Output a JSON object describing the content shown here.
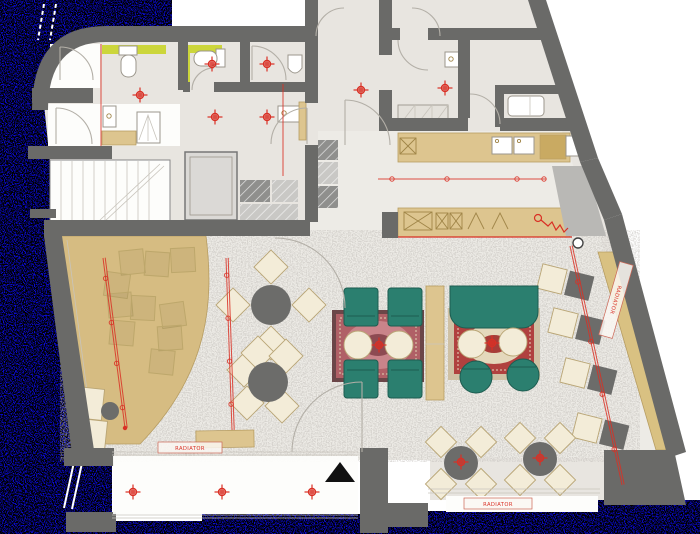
{
  "document": {
    "kind": "Scanned architectural floor plan",
    "subject": "Cafe lounge ground floor with bathrooms, kitchen bar, seating platform and terrace"
  },
  "labels": {
    "radiator_left": "RADIATOR",
    "radiator_bottom": "RADIATOR",
    "radiator_right": "RADIATOR"
  },
  "colors": {
    "scan_blue": "#0b0bd6",
    "wall": "#6a6a68",
    "floor_main": "#edebe6",
    "floor_rooms": "#e8e5e0",
    "floor_white": "#fdfdfb",
    "platform": "#d6bc82",
    "counter": "#ddc58f",
    "counter_dark": "#c9aa62",
    "bench": "#d9c182",
    "cream": "#f3ecd8",
    "cream_stroke": "#b9a575",
    "dark_table": "#6c6c6a",
    "teal": "#2b7f6f",
    "teal_dark": "#1d5c50",
    "rug1_border": "#6b4648",
    "rug1_field": "#b06066",
    "rug2_border": "#cfc1a4",
    "rug2_field": "#b0413f",
    "accent_red": "#d93025",
    "highlight_yellow": "#ccd63b",
    "vestibule_gray": "#b9b8b5",
    "hatch_dark": "#8f8f8d",
    "hatch_light": "#c9c8c5",
    "line_gray": "#b3afa7"
  },
  "symbols": {
    "crosshair": "ceiling light point",
    "double_red_line": "track lighting",
    "red_zigzag": "pendant cord at bar",
    "black_triangle": "entrance marker"
  },
  "counts": {
    "ceiling_light_crosshairs": 14,
    "track_lights": 4,
    "round_dining_tables": 4,
    "lounge_rugs": 2,
    "teal_armchairs": 4,
    "radiator_labels": 3
  }
}
